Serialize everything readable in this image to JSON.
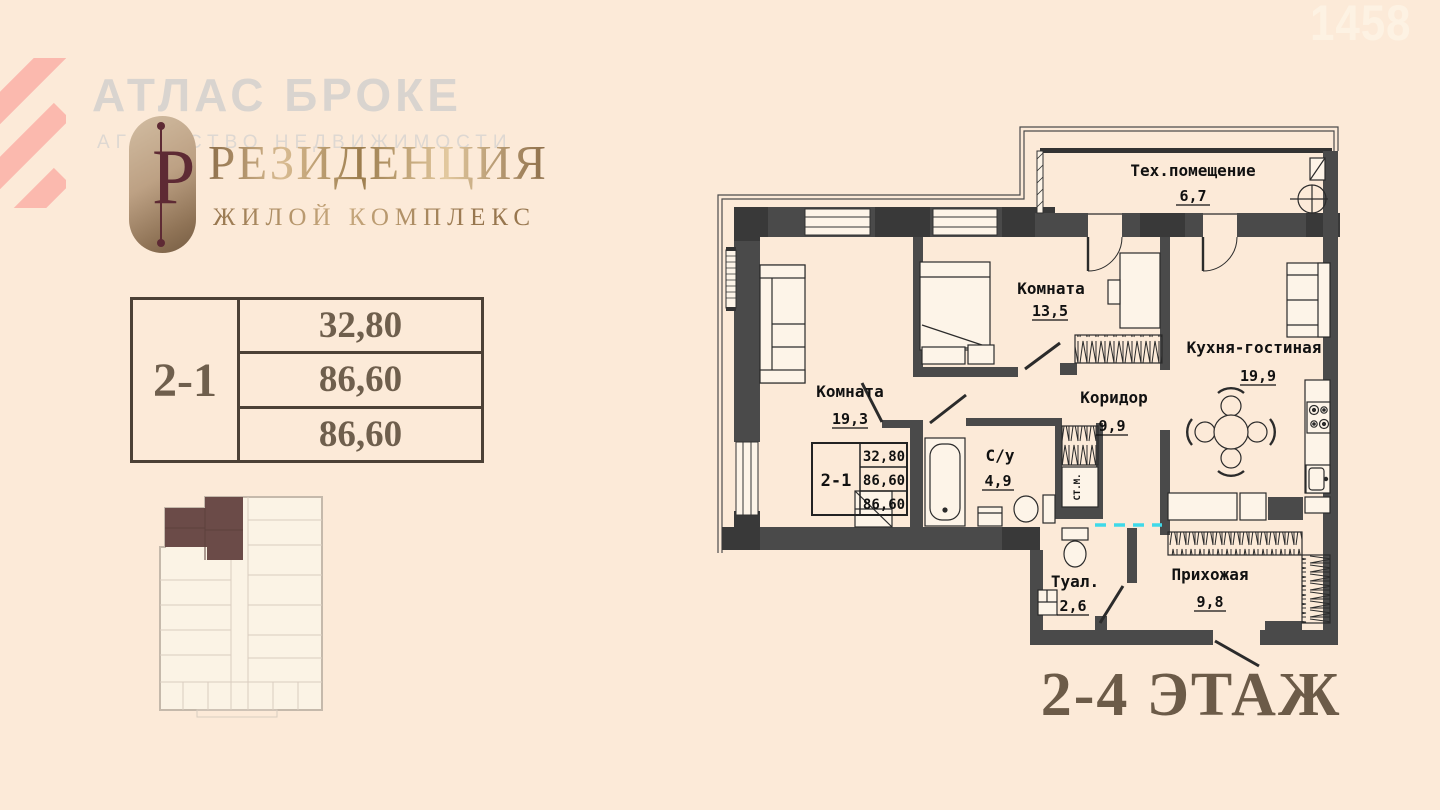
{
  "watermark": {
    "agency_name": "АТЛАС БРОКЕ",
    "agency_subtitle": "АГЕНТСТВО НЕДВИЖИМОСТИ",
    "photo_number": "1458"
  },
  "brand": {
    "emblem_letter": "Р",
    "name": "РЕЗИДЕНЦИЯ",
    "subtitle": "ЖИЛОЙ КОМПЛЕКС"
  },
  "unit_table": {
    "unit": "2-1",
    "rows": [
      "32,80",
      "86,60",
      "86,60"
    ]
  },
  "plan": {
    "floor_label": "2-4 ЭТАЖ",
    "washer_label": "СТ.М.",
    "rooms": [
      {
        "name": "Тех.помещение",
        "area": "6,7"
      },
      {
        "name": "Комната",
        "area": "13,5"
      },
      {
        "name": "Кухня-гостиная",
        "area": "19,9"
      },
      {
        "name": "Комната",
        "area": "19,3"
      },
      {
        "name": "Коридор",
        "area": "9,9"
      },
      {
        "name": "С/у",
        "area": "4,9"
      },
      {
        "name": "Туал.",
        "area": "2,6"
      },
      {
        "name": "Прихожая",
        "area": "9,8"
      }
    ],
    "stamp": {
      "unit": "2-1",
      "rows": [
        "32,80",
        "86,60",
        "86,60"
      ]
    }
  },
  "colors": {
    "background": "#fcead8",
    "wall": "#4a4a4a",
    "wall_dark": "#393939",
    "logo_stripes": "#fbb9ae",
    "brand_gold": "#c8a97e",
    "badge_top": "#d2bda2",
    "badge_bottom": "#755c42",
    "emblem_letter_color": "#5e2a34",
    "table_text": "#6f5f4d",
    "highlight_unit": "#6b4b48",
    "marker_cyan": "#3fd9e9"
  }
}
